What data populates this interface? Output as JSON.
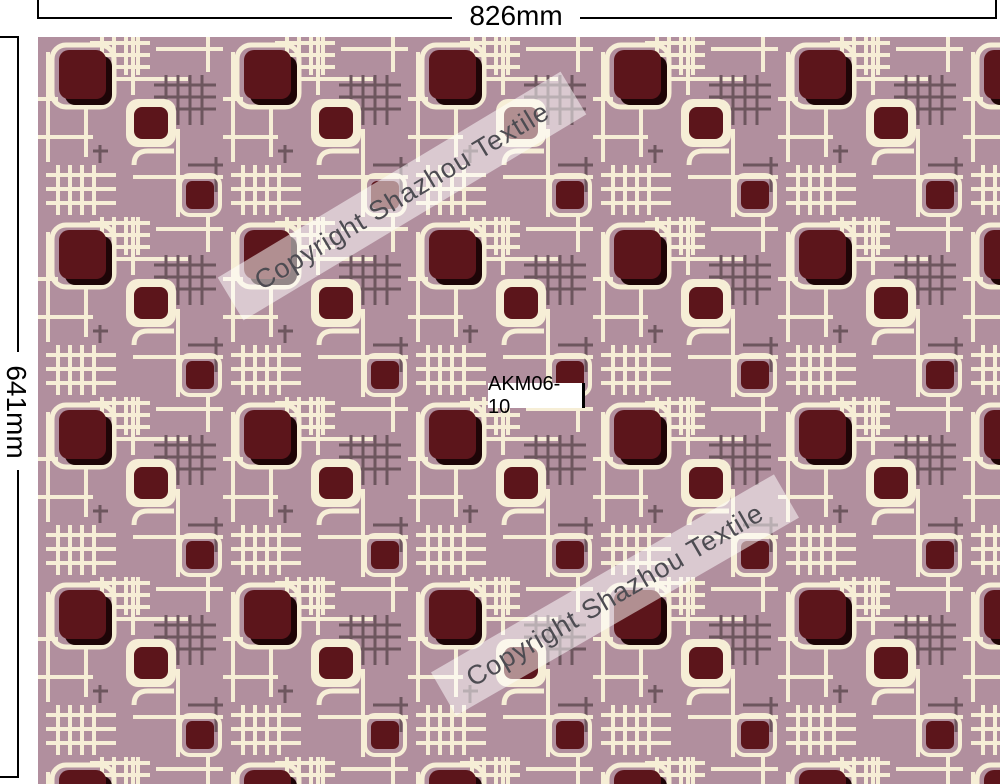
{
  "dimensions": {
    "width_label": "826mm",
    "height_label": "641mm"
  },
  "pattern_label": "AKM06-10",
  "watermark": {
    "text": "Copyright Shazhou Textile"
  },
  "colors": {
    "page_bg": "#ffffff",
    "fabric_bg": "#b18f9e",
    "fabric_maroon": "#5c151b",
    "fabric_shadow": "#1e0507",
    "fabric_cream": "#f6eed6",
    "fabric_gray": "#6d565e",
    "dim_line": "#000000",
    "watermark_band": "rgba(255,255,255,0.52)",
    "watermark_text": "#4d4c52",
    "label_bg": "#ffffff",
    "label_text": "#000000"
  }
}
